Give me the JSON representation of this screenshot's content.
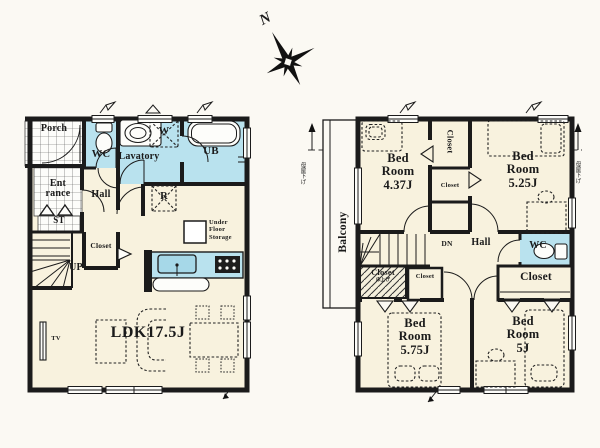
{
  "palette": {
    "wall": "#1b1b1b",
    "floor": "#f8f2de",
    "wet": "#b9e2ee",
    "ink": "#1a1a1a",
    "bg": "#fbf9f3"
  },
  "compass": {
    "north": "N"
  },
  "floor1": {
    "porch": "Porch",
    "wc": "WC",
    "lavatory": "Lavatory",
    "washing_machine": "W",
    "unit_bath": "UB",
    "entrance": "Ent\nrance",
    "hall": "Hall",
    "shoe_storage": "ST",
    "refrigerator": "R",
    "closet": "Closet",
    "under_floor_storage": "Under\nFloor\nStorage",
    "stairs": "UP",
    "tv": "TV",
    "living_dining_kitchen": "LDK17.5J"
  },
  "floor2": {
    "balcony": "Balcony",
    "bedroom_nw": "Bed\nRoom\n4.37J",
    "bedroom_ne": "Bed\nRoom\n5.25J",
    "bedroom_sw": "Bed\nRoom\n5.75J",
    "bedroom_se": "Bed\nRoom\n5J",
    "closet_nw_tall": "Closet",
    "closet_nw_small": "Closet",
    "closet_w_hatched": "Closet",
    "closet_w_hatched_note": "床上げ",
    "closet_center_small": "Closet",
    "closet_se_large": "Closet",
    "stairs": "DN",
    "hall": "Hall",
    "wc": "WC",
    "eaves_note_left": "母屋下げ",
    "eaves_note_right": "母屋下げ"
  }
}
